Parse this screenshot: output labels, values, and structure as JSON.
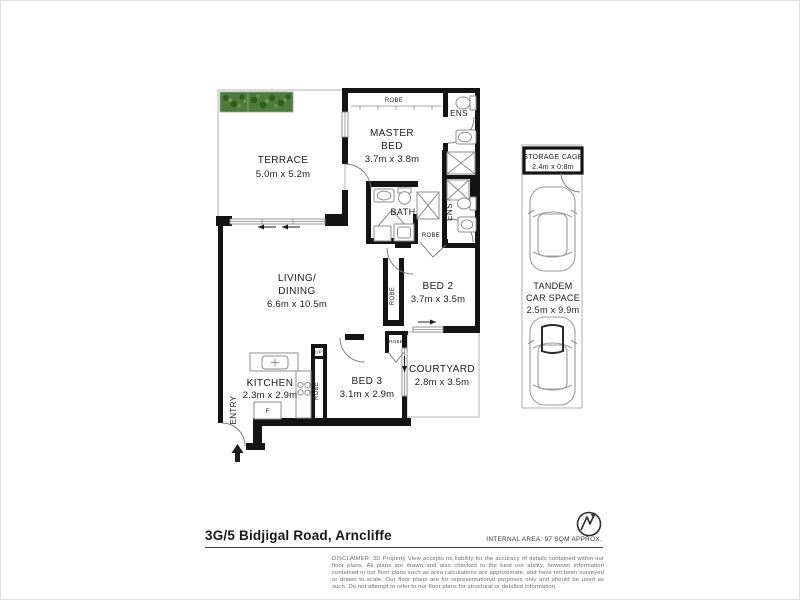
{
  "rooms": {
    "terrace": {
      "name": "TERRACE",
      "dims": "5.0m x 5.2m"
    },
    "master_bed": {
      "line1": "MASTER",
      "line2": "BED",
      "dims": "3.7m x 3.8m"
    },
    "living": {
      "line1": "LIVING/",
      "line2": "DINING",
      "dims": "6.6m x 10.5m"
    },
    "bed2": {
      "name": "BED 2",
      "dims": "3.7m x 3.5m"
    },
    "bed3": {
      "name": "BED 3",
      "dims": "3.1m x 2.9m"
    },
    "courtyard": {
      "name": "COURTYARD",
      "dims": "2.8m x 3.5m"
    },
    "kitchen": {
      "name": "KITCHEN",
      "dims": "2.3m x 2.9m"
    },
    "bath": {
      "name": "BATH"
    },
    "ens": {
      "name": "ENS"
    },
    "entry": {
      "name": "ENTRY"
    },
    "robe": {
      "name": "ROBE"
    },
    "cupboard": {
      "name": "CUP'D"
    },
    "fridge": {
      "name": "F"
    }
  },
  "parking": {
    "storage_cage": {
      "name": "STORAGE CAGE",
      "dims": "2.4m x 0.8m"
    },
    "tandem": {
      "line1": "TANDEM",
      "line2": "CAR SPACE",
      "dims": "2.5m x 9.9m"
    }
  },
  "footer": {
    "address": "3G/5 Bidjigal Road, Arncliffe",
    "internal_area": "INTERNAL AREA: 97 SQM APPROX.",
    "disclaimer": "DISCLAIMER: 3D Property View accepts no liability for the accuracy of details contained within our floor plans. All plans are drawn and also checked to the best our ability, however information contained in our floor plans such as area calculations are approximate, and have not been surveyed or drawn to scale. Our floor plans are for representational purposes only and should be used as such. Do not attempt to refer to our floor plans for structural or detailed information."
  },
  "colors": {
    "wall": "#141414",
    "outline": "#b3b3b3",
    "plant_green": "#4d7c3a",
    "text": "#1b1b1b"
  }
}
